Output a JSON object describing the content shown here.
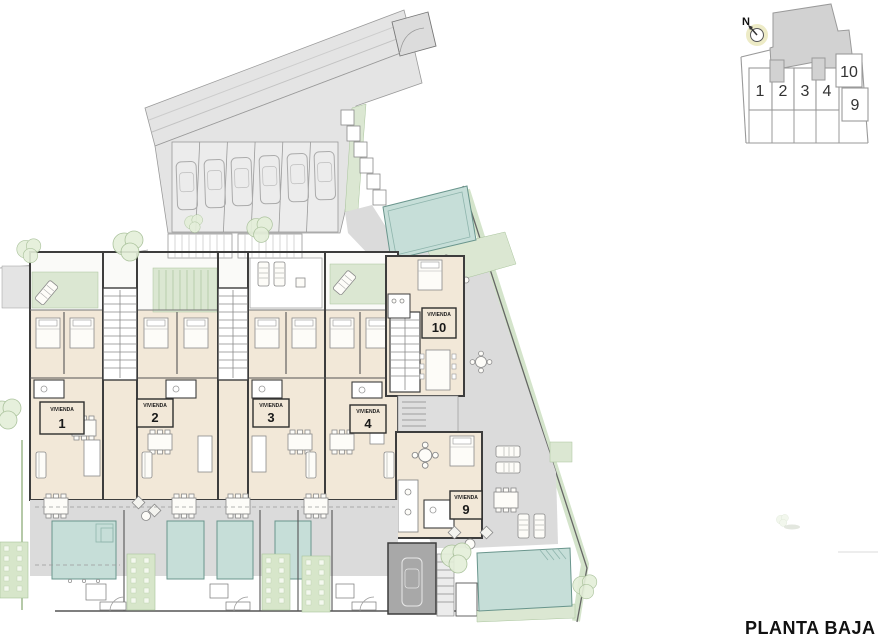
{
  "title": "PLANTA BAJA",
  "compass": {
    "label": "N"
  },
  "units": [
    {
      "name": "VIVIENDA",
      "number": "1"
    },
    {
      "name": "VIVIENDA",
      "number": "2"
    },
    {
      "name": "VIVIENDA",
      "number": "3"
    },
    {
      "name": "VIVIENDA",
      "number": "4"
    },
    {
      "name": "VIVIENDA",
      "number": "9"
    },
    {
      "name": "VIVIENDA",
      "number": "10"
    }
  ],
  "keyplan": {
    "cells": [
      {
        "number": "1"
      },
      {
        "number": "2"
      },
      {
        "number": "3"
      },
      {
        "number": "4"
      },
      {
        "number": "9"
      },
      {
        "number": "10"
      }
    ]
  },
  "colors": {
    "interior_beige": "#f2e8d8",
    "terrace_green": "#dbe7d2",
    "pool_teal": "#c6ded8",
    "wall_dark": "#3d3d3d",
    "paving_grey": "#e4e4e4",
    "deck_grey": "#dbdbdb",
    "garage_grey": "#a8a8a8",
    "keyplan_mass_grey": "#d2d2d2"
  }
}
